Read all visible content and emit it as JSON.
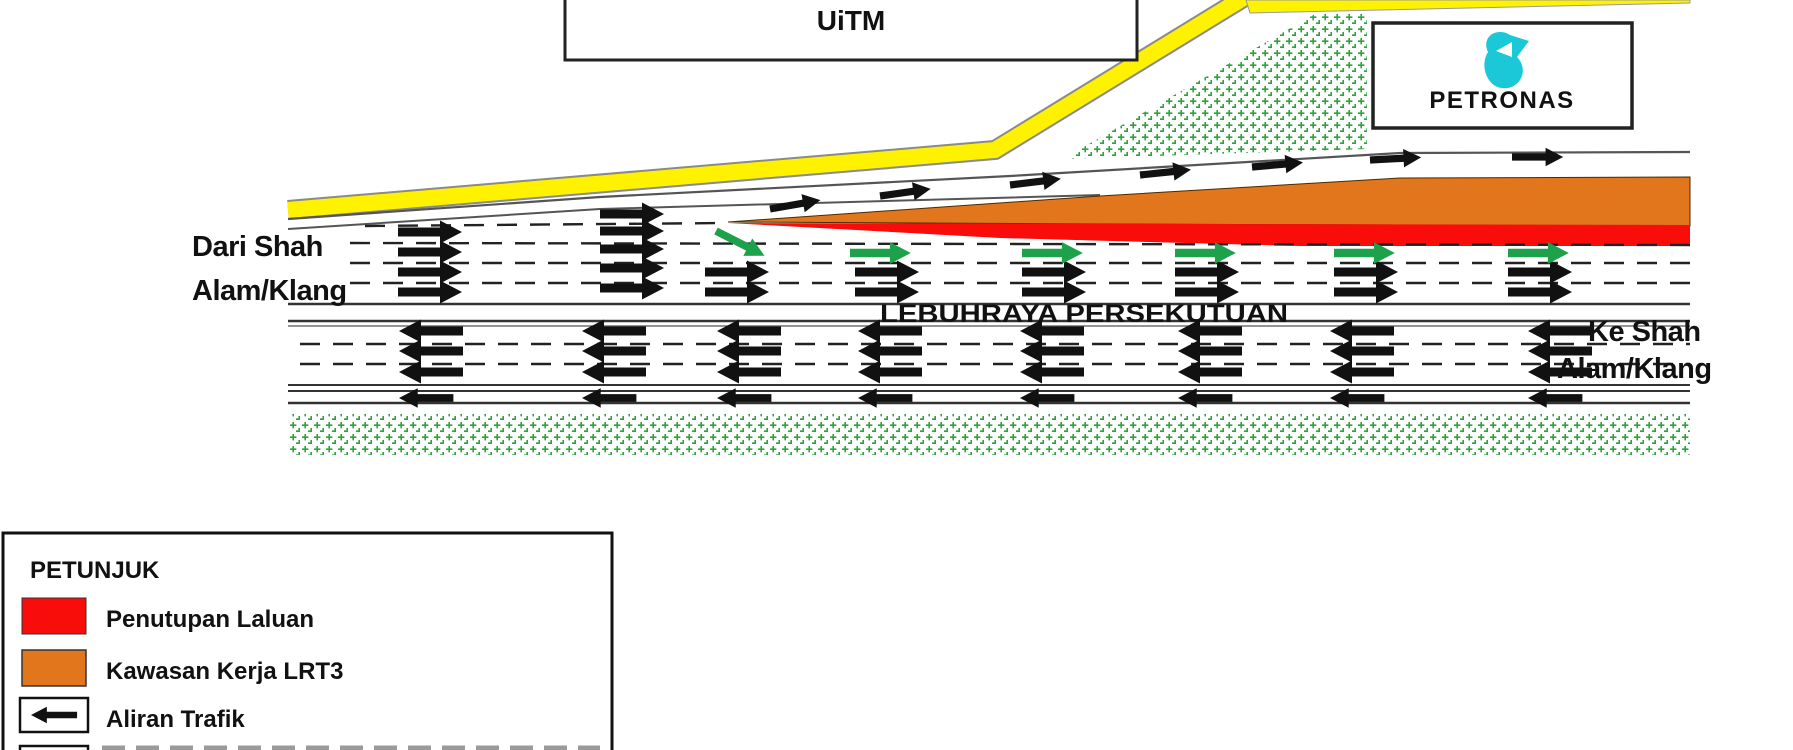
{
  "labels": {
    "uitm": "UiTM",
    "petronas": "PETRONAS",
    "origin_line1": "Dari Shah",
    "origin_line2": "Alam/Klang",
    "highway": "LEBUHRAYA PERSEKUTUAN",
    "destination_line1": "Ke Shah",
    "destination_line2": "Alam/Klang"
  },
  "legend": {
    "title": "PETUNJUK",
    "items": [
      {
        "swatch": "red",
        "label": "Penutupan Laluan"
      },
      {
        "swatch": "orange",
        "label": "Kawasan Kerja LRT3"
      },
      {
        "swatch": "arrow-left",
        "label": "Aliran Trafik"
      },
      {
        "swatch": "partial-cutoff",
        "label": ""
      }
    ]
  },
  "colors": {
    "lane_closure_red": "#F90D0B",
    "work_zone_orange": "#E2761C",
    "diversion_green": "#1DA14A",
    "vegetation_green": "#2EA33C",
    "road_yellow": "#FFF200",
    "petronas_teal": "#1AC8D8",
    "arrow_black": "#111111",
    "road_line": "#555555"
  }
}
